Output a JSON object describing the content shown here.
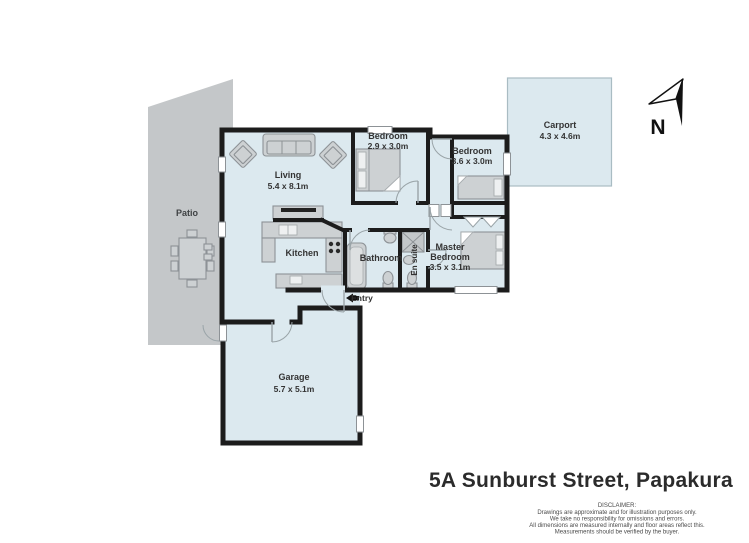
{
  "colors": {
    "floor": "#dce9ef",
    "patio": "#c4c7c9",
    "wall": "#1c1c1c",
    "carport_border": "#a9bcc3",
    "furniture": "#cdd1d3",
    "furniture_border": "#8d9296",
    "door": "#9aa4a8",
    "text": "#333333"
  },
  "compass": {
    "label": "N"
  },
  "entry": {
    "label": "Entry"
  },
  "rooms": {
    "living": {
      "name": "Living",
      "dims": "5.4 x 8.1m"
    },
    "bedroom1": {
      "name": "Bedroom",
      "dims": "2.9 x 3.0m"
    },
    "bedroom2": {
      "name": "Bedroom",
      "dims": "3.6 x 3.0m"
    },
    "master": {
      "line1": "Master",
      "line2": "Bedroom",
      "dims": "3.5 x 3.1m"
    },
    "kitchen": {
      "name": "Kitchen"
    },
    "bathroom": {
      "name": "Bathroom"
    },
    "ensuite": {
      "name": "En suite"
    },
    "garage": {
      "name": "Garage",
      "dims": "5.7 x 5.1m"
    },
    "patio": {
      "name": "Patio"
    },
    "carport": {
      "name": "Carport",
      "dims": "4.3 x 4.6m"
    }
  },
  "footer": {
    "address": "5A Sunburst Street, Papakura",
    "disclaimer_title": "DISCLAIMER:",
    "disclaimer_lines": [
      "Drawings are approximate and for illustration purposes only.",
      "We take no responsibility for omissions and errors.",
      "All dimensions are measured internally and floor areas reflect this.",
      "Measurements should be verified by the buyer."
    ]
  }
}
